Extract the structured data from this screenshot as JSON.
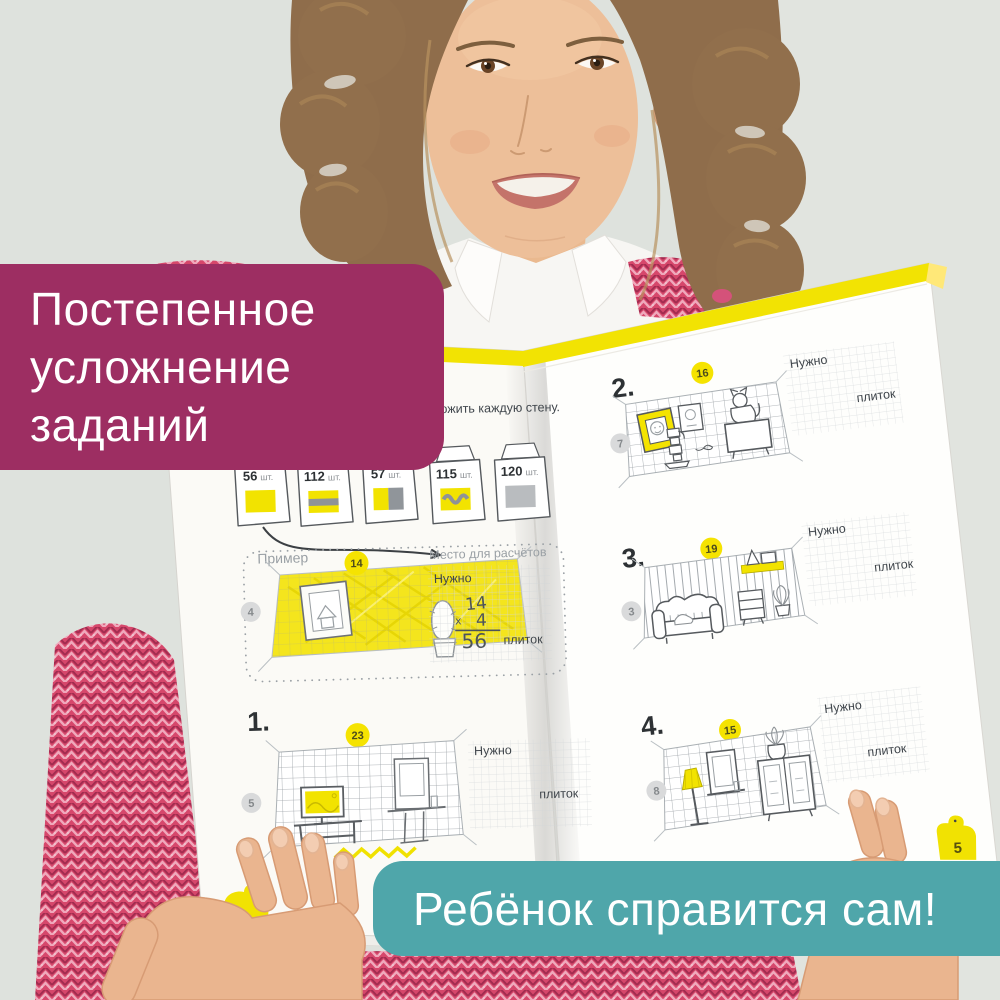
{
  "overlays": {
    "top_left": {
      "lines": [
        "Постепенное",
        "усложнение",
        "заданий"
      ]
    },
    "bottom_right": {
      "text": "Ребёнок справится сам!"
    }
  },
  "book": {
    "left_page": {
      "instruction_line1": ", чтобы выложить каждую стену.",
      "instruction_line2": "дей плитки.",
      "tile_packs": [
        {
          "count": "56",
          "unit": "шт."
        },
        {
          "count": "112",
          "unit": "шт."
        },
        {
          "count": "57",
          "unit": "шт."
        },
        {
          "count": "115",
          "unit": "шт."
        },
        {
          "count": "120",
          "unit": "шт."
        }
      ],
      "example": {
        "label": "Пример",
        "width_badge": "14",
        "height_badge": "4",
        "calc_area_label": "Место для расчётов",
        "need_label": "Нужно",
        "multiplicand": "14",
        "multiply_sign": "х",
        "multiplier": "4",
        "result": "56",
        "units_label": "плиток"
      },
      "task1": {
        "number": "1.",
        "width_badge": "23",
        "height_badge": "5",
        "need_label": "Нужно",
        "units_label": "плиток"
      }
    },
    "right_page": {
      "task2": {
        "number": "2.",
        "width_badge": "16",
        "height_badge": "7",
        "need_label": "Нужно",
        "units_label": "плиток"
      },
      "task3": {
        "number": "3.",
        "width_badge": "19",
        "height_badge": "3",
        "need_label": "Нужно",
        "units_label": "плиток"
      },
      "task4": {
        "number": "4.",
        "width_badge": "15",
        "height_badge": "8",
        "need_label": "Нужно",
        "units_label": "плиток"
      },
      "page_tab": "5"
    }
  },
  "colors": {
    "background": "#dee2dd",
    "banner_purple": "#9d2e62",
    "banner_teal": "#4fa6aa",
    "book_yellow": "#f2e303",
    "badge_yellow": "#f5e301",
    "badge_gray": "#d9dadb",
    "sweater_pink": "#d6476b",
    "skin": "#ecbe98",
    "hair": "#8f6d4b"
  }
}
